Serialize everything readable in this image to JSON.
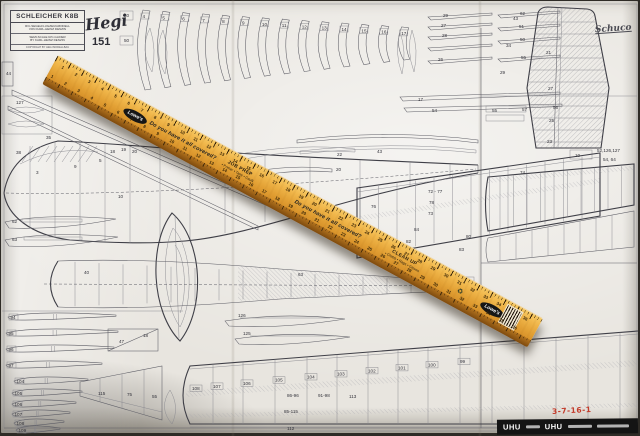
{
  "title_block": {
    "title": "SCHLEICHER K8B",
    "subtitle_de_1": "R/C-SEGELFLUGZEUGMODELL",
    "subtitle_de_2": "VON KARL-HEINZ DENZIN",
    "subtitle_en_1": "SEMI-SCALE R/C-GLIDER",
    "subtitle_en_2": "BY KARL-HEINZ DENZIN",
    "copyright": "COPYRIGHT BY HEGI MODELLBAU"
  },
  "brand": {
    "logo": "Hegi",
    "plan_number": "151",
    "schuco_logo": "Schuco"
  },
  "ruler": {
    "brand": "Lowe's",
    "slogan": "Do you have it all covered?",
    "block1_title": "JOB PREP",
    "block1_items": "• Primer • Tape • Caulk",
    "block2_title": "CLEAN UP",
    "block2_items": "• Cloths • Rags • Gloves",
    "recycle_icon": "♻",
    "scale_numbers": [
      1,
      2,
      3,
      4,
      5,
      6,
      7,
      8,
      9,
      10,
      11,
      12,
      13,
      14,
      15,
      16,
      17,
      18,
      19,
      20,
      21,
      22,
      23,
      24,
      25,
      26,
      27,
      28,
      29,
      30,
      31,
      32,
      33,
      34,
      35,
      36
    ]
  },
  "uhu_strip": {
    "brand_left": "UHU",
    "brand_right": "UHU"
  },
  "handwritten_note": "3-7-16-1",
  "plan": {
    "former_numbers": [
      "4",
      "5",
      "6",
      "7",
      "8",
      "9",
      "10",
      "11",
      "12",
      "13",
      "14",
      "15",
      "16",
      "17"
    ],
    "rib_stack_numbers": [
      "94",
      "95",
      "96",
      "97",
      "104",
      "105",
      "106",
      "107",
      "108",
      "109"
    ],
    "bottom_wing_rib_numbers": [
      "108",
      "107",
      "106",
      "105",
      "104",
      "103",
      "102",
      "101",
      "100",
      "99"
    ],
    "labels": [
      [
        124,
        17,
        "30"
      ],
      [
        124,
        42,
        "50"
      ],
      [
        443,
        17,
        "29"
      ],
      [
        441,
        27,
        "27"
      ],
      [
        442,
        37,
        "28"
      ],
      [
        438,
        61,
        "26"
      ],
      [
        520,
        15,
        "62"
      ],
      [
        519,
        28,
        "51"
      ],
      [
        520,
        41,
        "50"
      ],
      [
        521,
        59,
        "55"
      ],
      [
        418,
        101,
        "17"
      ],
      [
        432,
        112,
        "54"
      ],
      [
        513,
        20,
        "43"
      ],
      [
        506,
        47,
        "34"
      ],
      [
        500,
        74,
        "29"
      ],
      [
        546,
        54,
        "21"
      ],
      [
        548,
        90,
        "27"
      ],
      [
        549,
        122,
        "25"
      ],
      [
        547,
        143,
        "23"
      ],
      [
        597,
        152,
        "52,126,127"
      ],
      [
        603,
        161,
        "54, 64"
      ],
      [
        16,
        154,
        "38"
      ],
      [
        46,
        139,
        "35"
      ],
      [
        99,
        162,
        "5"
      ],
      [
        110,
        153,
        "18"
      ],
      [
        121,
        151,
        "19"
      ],
      [
        132,
        153,
        "20"
      ],
      [
        74,
        168,
        "9"
      ],
      [
        36,
        174,
        "3"
      ],
      [
        118,
        198,
        "10"
      ],
      [
        12,
        223,
        "62"
      ],
      [
        12,
        241,
        "63"
      ],
      [
        298,
        276,
        "63"
      ],
      [
        84,
        274,
        "40"
      ],
      [
        238,
        317,
        "126"
      ],
      [
        243,
        335,
        "125"
      ],
      [
        428,
        193,
        "72 - 77"
      ],
      [
        429,
        204,
        "78"
      ],
      [
        428,
        215,
        "73"
      ],
      [
        520,
        174,
        "74"
      ],
      [
        371,
        208,
        "76"
      ],
      [
        414,
        231,
        "84"
      ],
      [
        406,
        243,
        "82"
      ],
      [
        466,
        238,
        "80"
      ],
      [
        459,
        251,
        "83"
      ],
      [
        337,
        156,
        "22"
      ],
      [
        336,
        171,
        "20"
      ],
      [
        377,
        153,
        "43"
      ],
      [
        492,
        112,
        "55"
      ],
      [
        522,
        111,
        "57"
      ],
      [
        553,
        109,
        "56"
      ],
      [
        575,
        157,
        "10"
      ],
      [
        287,
        397,
        "86-96"
      ],
      [
        318,
        397,
        "91-98"
      ],
      [
        349,
        398,
        "113"
      ],
      [
        284,
        413,
        "85-115"
      ],
      [
        287,
        430,
        "112"
      ],
      [
        98,
        395,
        "115"
      ],
      [
        127,
        396,
        "75"
      ],
      [
        152,
        398,
        "55"
      ],
      [
        119,
        343,
        "47"
      ],
      [
        143,
        337,
        "18"
      ],
      [
        6,
        75,
        "44"
      ],
      [
        16,
        104,
        "127"
      ]
    ]
  }
}
